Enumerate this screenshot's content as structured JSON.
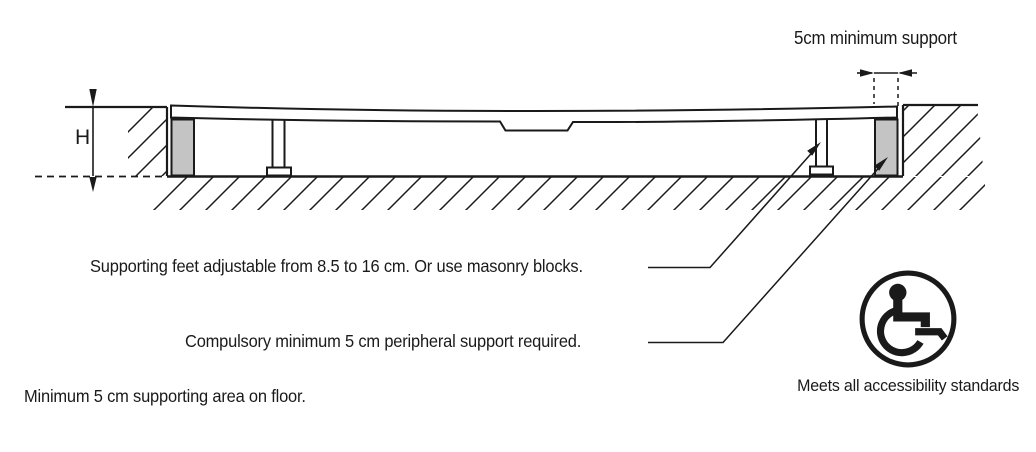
{
  "diagram": {
    "title_hint": "shower-tray installation cross-section",
    "dimension_top": {
      "label": "5cm minimum support"
    },
    "dimension_height": {
      "label": "H"
    },
    "callouts": {
      "supporting_feet": "Supporting feet adjustable from 8.5 to 16 cm. Or use masonry blocks.",
      "peripheral_support": "Compulsory minimum 5 cm peripheral support required.",
      "floor_support": "Minimum 5 cm supporting area on floor."
    },
    "accessibility": {
      "caption": "Meets all accessibility standards"
    },
    "colors": {
      "line": "#1a1a1a",
      "support_block_fill": "#c4c4c4",
      "background": "#ffffff"
    }
  }
}
